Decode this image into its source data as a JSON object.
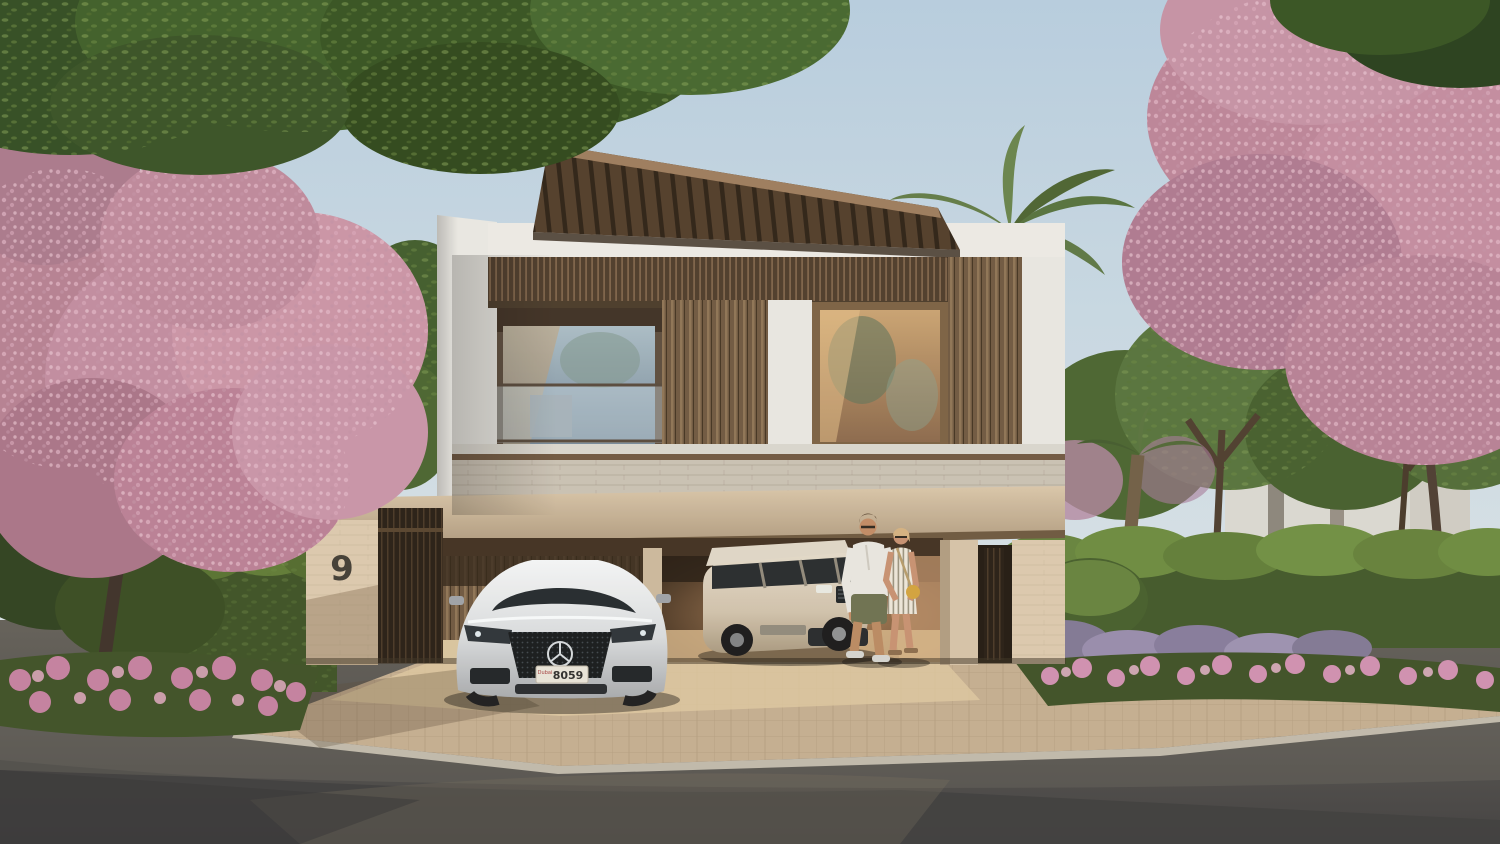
{
  "scene": {
    "title": "Modern luxury villa exterior at golden hour",
    "setting": "Three-storey contemporary villa with wooden slat facade, louvered roof pergola, carport and landscaped street framed by pink trumpet trees",
    "house_number": "9",
    "vehicles": [
      {
        "name": "mercedes-eqs-sedan",
        "color": "silver-white",
        "position": "parked on driveway in front of carport",
        "license_plate": {
          "region": "Dubai",
          "number": "8059"
        }
      },
      {
        "name": "range-rover-suv",
        "color": "champagne-white",
        "position": "parked inside open garage"
      }
    ],
    "people": [
      {
        "name": "man",
        "outfit": "white shirt, olive shorts, sneakers, sunglasses"
      },
      {
        "name": "woman",
        "outfit": "striped summer dress, yellow handbag, sunglasses"
      }
    ],
    "landscape": [
      "pink trumpet blossom tree left",
      "pink trumpet blossom tree right",
      "green canopy overhanging top",
      "clipped green hedges",
      "pink flower beds along kerb",
      "lavender shrubs",
      "palm trees behind villa",
      "white neighbour villa behind trees on the right"
    ]
  },
  "colors": {
    "sky_top": "#b6cde0",
    "sky_bottom": "#e6ebe9",
    "facade_white": "#e5e4e0",
    "wood_slat_dark": "#4b3929",
    "wood_slat_light": "#7b6047",
    "stone_band": "#c9c1b4",
    "brick_pillar": "#d8c5ab",
    "blossom_pink": "#c08ba0",
    "foliage_green": "#3f5a2a",
    "asphalt": "#4f4e4c",
    "paver": "#cdb795",
    "warm_interior": "#c89b66"
  }
}
